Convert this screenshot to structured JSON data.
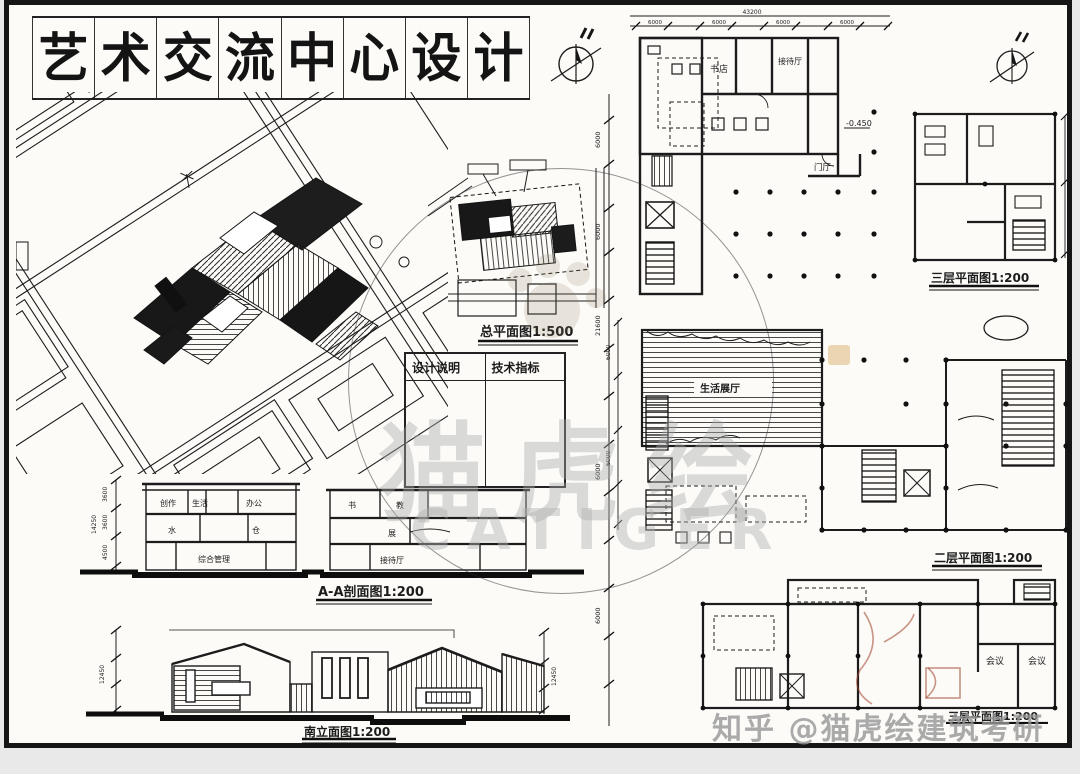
{
  "page": {
    "background": "#e9e9e9",
    "sheet_bg": "#fcfbf8",
    "ink": "#1c1c1c",
    "watermark_gray": "#b4b4b4",
    "accent_tan": "#d8a75d"
  },
  "title": {
    "text": "艺术交流中心设计",
    "chars": [
      "艺",
      "术",
      "交",
      "流",
      "中",
      "心",
      "设",
      "计"
    ]
  },
  "site_plan": {
    "label": "总平面图1:500"
  },
  "notes_table": {
    "col1": "设计说明",
    "col2": "技术指标"
  },
  "section": {
    "label": "A-A剖面图1:200",
    "rooms_left": [
      "创作",
      "生活",
      "办公",
      "水",
      "仓",
      "综合管理"
    ],
    "rooms_right": [
      "书",
      "教",
      "展",
      "接待厅"
    ],
    "dims": [
      "3600",
      "3600",
      "4500",
      "14250"
    ]
  },
  "elevation": {
    "label": "南立面图1:200",
    "dim_total": "12450"
  },
  "plans": {
    "first": {
      "rooms": [
        "书店",
        "接待厅",
        "门厅"
      ],
      "level": "-0.450",
      "dim_bay": "6000",
      "dim_total": "43200"
    },
    "second": {
      "label": "二层平面图1:200",
      "room": "生活展厅",
      "dim_bay": "6000"
    },
    "third": {
      "label": "三层平面图1:200"
    },
    "bottom": {
      "label": "三层平面图1:200",
      "rooms": [
        "会议",
        "会议"
      ]
    }
  },
  "dim_strip": {
    "bay": "6000",
    "total": "21600"
  },
  "watermark": {
    "brand": "猫虎绘",
    "brand_latin": "CATIGER",
    "zhihu": "知乎 @猫虎绘建筑考研"
  }
}
